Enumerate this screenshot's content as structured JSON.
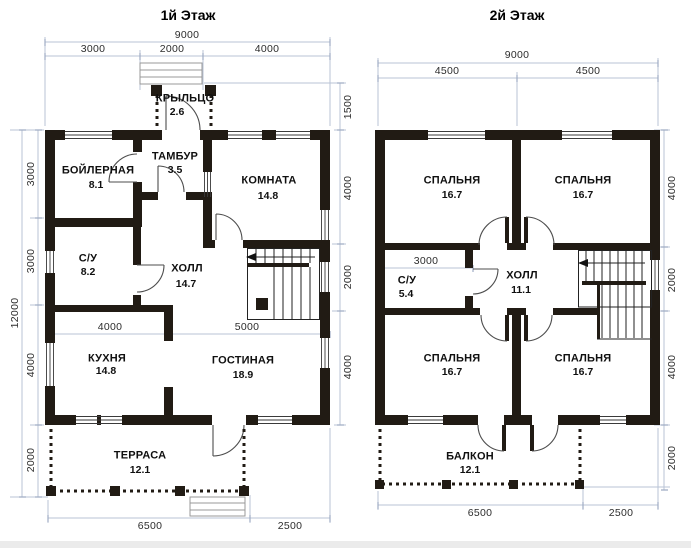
{
  "plan1": {
    "title": "1й Этаж",
    "rooms": [
      {
        "name": "КРЫЛЬЦО",
        "area": "2.6"
      },
      {
        "name": "ТАМБУР",
        "area": "3.5"
      },
      {
        "name": "БОЙЛЕРНАЯ",
        "area": "8.1"
      },
      {
        "name": "КОМНАТА",
        "area": "14.8"
      },
      {
        "name": "С/У",
        "area": "8.2"
      },
      {
        "name": "ХОЛЛ",
        "area": "14.7"
      },
      {
        "name": "КУХНЯ",
        "area": "14.8"
      },
      {
        "name": "ГОСТИНАЯ",
        "area": "18.9"
      },
      {
        "name": "ТЕРРАСА",
        "area": "12.1"
      }
    ],
    "dims": {
      "top_total": "9000",
      "top": [
        "3000",
        "2000",
        "4000"
      ],
      "left_total": "12000",
      "left": [
        "3000",
        "3000",
        "4000",
        "2000"
      ],
      "right": [
        "1500",
        "4000",
        "2000",
        "4000"
      ],
      "bottom": [
        "6500",
        "2500"
      ],
      "inner": [
        "4000",
        "5000"
      ]
    }
  },
  "plan2": {
    "title": "2й Этаж",
    "rooms": [
      {
        "name": "СПАЛЬНЯ",
        "area": "16.7"
      },
      {
        "name": "СПАЛЬНЯ",
        "area": "16.7"
      },
      {
        "name": "С/У",
        "area": "5.4"
      },
      {
        "name": "ХОЛЛ",
        "area": "11.1"
      },
      {
        "name": "СПАЛЬНЯ",
        "area": "16.7"
      },
      {
        "name": "СПАЛЬНЯ",
        "area": "16.7"
      },
      {
        "name": "БАЛКОН",
        "area": "12.1"
      }
    ],
    "dims": {
      "top_total": "9000",
      "top": [
        "4500",
        "4500"
      ],
      "right": [
        "4000",
        "2000",
        "4000",
        "2000"
      ],
      "bottom": [
        "6500",
        "2500"
      ],
      "inner": [
        "3000"
      ]
    }
  },
  "colors": {
    "wall": "#211b14",
    "dim_line": "#b9c3d6",
    "dim_tick": "#9facc4",
    "text": "#101010"
  }
}
